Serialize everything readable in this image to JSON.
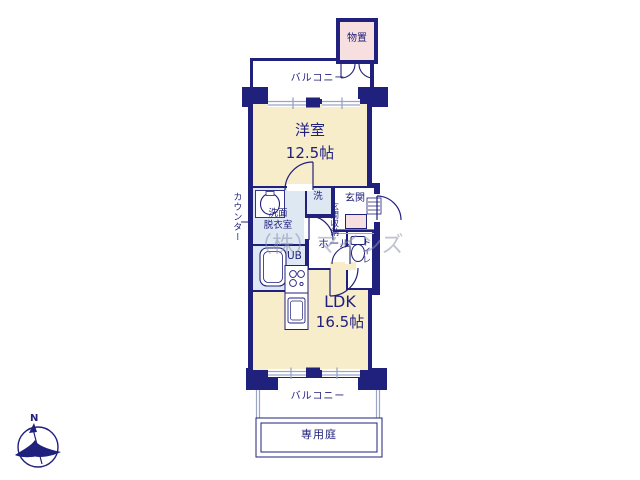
{
  "colors": {
    "wall_navy": "#20207d",
    "room_cream": "#f8edcb",
    "wet_blue": "#dde8f3",
    "storage_pink": "#f8dfdf",
    "window_gray": "#9aa4c6",
    "white": "#ffffff"
  },
  "plan": {
    "storage": {
      "label": "物置"
    },
    "balcony_top": {
      "label": "バルコニー"
    },
    "western_room": {
      "label": "洋室",
      "size": "12.5帖"
    },
    "washroom": {
      "line1": "洗面",
      "line2": "脱衣室"
    },
    "laundry": {
      "label": "洗"
    },
    "entrance": {
      "label": "玄関"
    },
    "entrance_storage": {
      "label": "玄関収納"
    },
    "hall": {
      "label": "ホール"
    },
    "unit_bath": {
      "label": "UB"
    },
    "toilet": {
      "label": "トイレ"
    },
    "counter": {
      "label": "カウンター"
    },
    "ldk": {
      "label": "LDK",
      "size": "16.5帖"
    },
    "balcony_bottom": {
      "label": "バルコニー"
    },
    "private_garden": {
      "label": "専用庭"
    },
    "compass": {
      "north": "N"
    },
    "watermark": {
      "text": "（株）マインズ"
    }
  }
}
